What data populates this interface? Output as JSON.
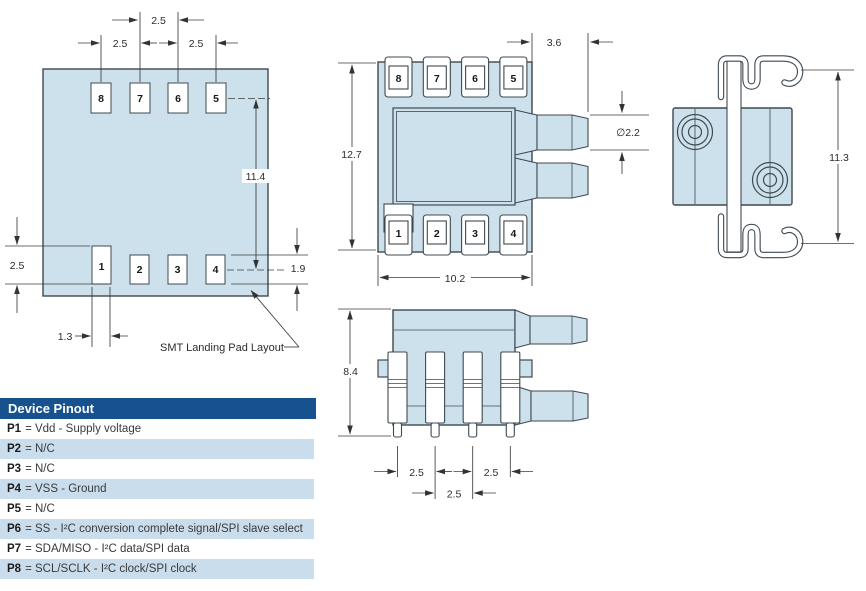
{
  "colors": {
    "body_fill": "#cde1ec",
    "outline": "#3e4950",
    "dim": "#3c3c3c",
    "header_bg": "#17528f",
    "band_bg": "#c9dded"
  },
  "drawing": {
    "landing_pad": {
      "caption": "SMT Landing Pad Layout",
      "pads_top": [
        "8",
        "7",
        "6",
        "5"
      ],
      "pads_bottom": [
        "1",
        "2",
        "3",
        "4"
      ],
      "dim_top_center": "2.5",
      "dim_top_left": "2.5",
      "dim_top_right": "2.5",
      "dim_vertical": "11.4",
      "dim_pad1_height": "2.5",
      "dim_pad4_height": "1.9",
      "dim_pad1_width": "1.3"
    },
    "top_view": {
      "pins_top": [
        "8",
        "7",
        "6",
        "5"
      ],
      "pins_bottom": [
        "1",
        "2",
        "3",
        "4"
      ],
      "dim_height": "12.7",
      "dim_width": "10.2",
      "dim_port_length": "3.6",
      "dim_port_diameter": "∅2.2"
    },
    "end_view": {
      "dim_height": "11.3"
    },
    "side_view": {
      "dim_height": "8.4",
      "dim_pitch_left": "2.5",
      "dim_pitch_center": "2.5",
      "dim_pitch_right": "2.5"
    }
  },
  "pinout": {
    "title": "Device Pinout",
    "rows": [
      {
        "pin": "P1",
        "desc": "= Vdd - Supply voltage"
      },
      {
        "pin": "P2",
        "desc": "= N/C"
      },
      {
        "pin": "P3",
        "desc": "= N/C"
      },
      {
        "pin": "P4",
        "desc": "= VSS - Ground"
      },
      {
        "pin": "P5",
        "desc": "= N/C"
      },
      {
        "pin": "P6",
        "desc": "= SS - I²C conversion complete signal/SPI slave select"
      },
      {
        "pin": "P7",
        "desc": "= SDA/MISO - I²C data/SPI data"
      },
      {
        "pin": "P8",
        "desc": "= SCL/SCLK - I²C clock/SPI clock"
      }
    ]
  }
}
